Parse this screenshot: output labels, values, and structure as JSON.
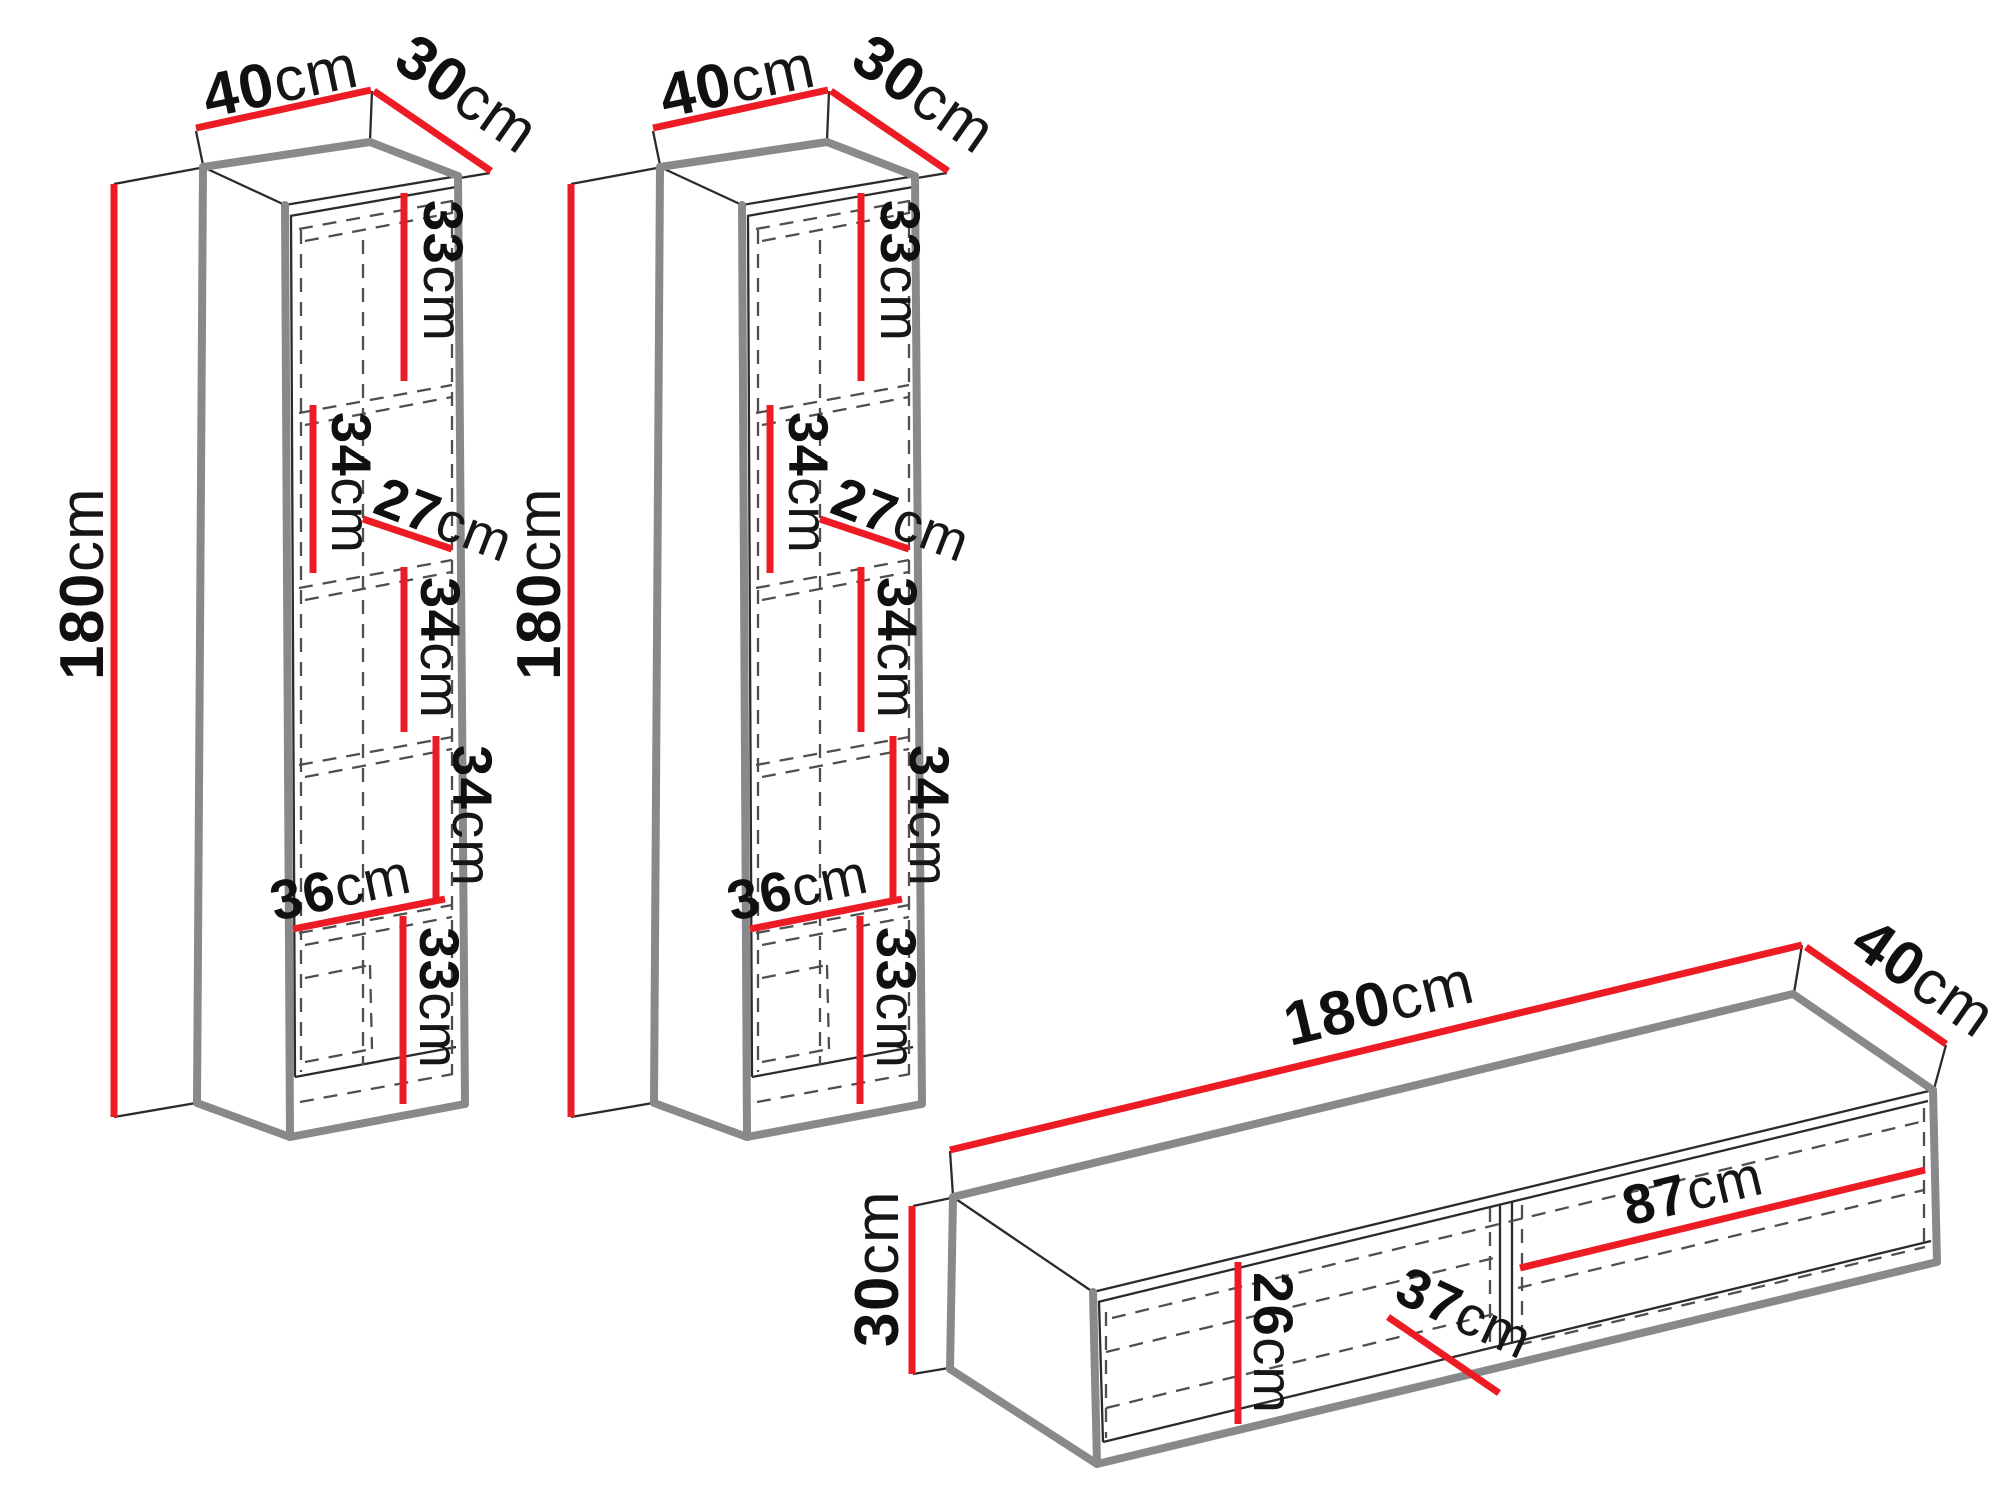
{
  "diagram_title": "Wall unit furniture dimensions diagram",
  "units": "cm",
  "colors": {
    "dimension_line": "#ED1C24",
    "edge_gray": "#87898b",
    "outline_black": "#2b2b2b",
    "background": "#ffffff"
  },
  "tall_cabinet": {
    "quantity": 2,
    "instances": [
      "tall-cabinet-1",
      "tall-cabinet-2"
    ],
    "overall": {
      "width": {
        "value": "40",
        "unit": "cm"
      },
      "depth": {
        "value": "30",
        "unit": "cm"
      },
      "height": {
        "value": "180",
        "unit": "cm"
      }
    },
    "compartments": [
      {
        "name": "compartment-1-height",
        "value": "33",
        "unit": "cm"
      },
      {
        "name": "compartment-2-height",
        "value": "34",
        "unit": "cm"
      },
      {
        "name": "shelf-interior-depth",
        "value": "27",
        "unit": "cm"
      },
      {
        "name": "compartment-3-height",
        "value": "34",
        "unit": "cm"
      },
      {
        "name": "compartment-4-height",
        "value": "34",
        "unit": "cm"
      },
      {
        "name": "interior-width",
        "value": "36",
        "unit": "cm"
      },
      {
        "name": "compartment-5-height",
        "value": "33",
        "unit": "cm"
      }
    ]
  },
  "tv_stand": {
    "overall": {
      "width": {
        "value": "180",
        "unit": "cm"
      },
      "depth": {
        "value": "40",
        "unit": "cm"
      },
      "height": {
        "value": "30",
        "unit": "cm"
      }
    },
    "interior": [
      {
        "name": "right-compartment-width",
        "value": "87",
        "unit": "cm"
      },
      {
        "name": "interior-depth",
        "value": "37",
        "unit": "cm"
      },
      {
        "name": "interior-height",
        "value": "26",
        "unit": "cm"
      }
    ]
  }
}
